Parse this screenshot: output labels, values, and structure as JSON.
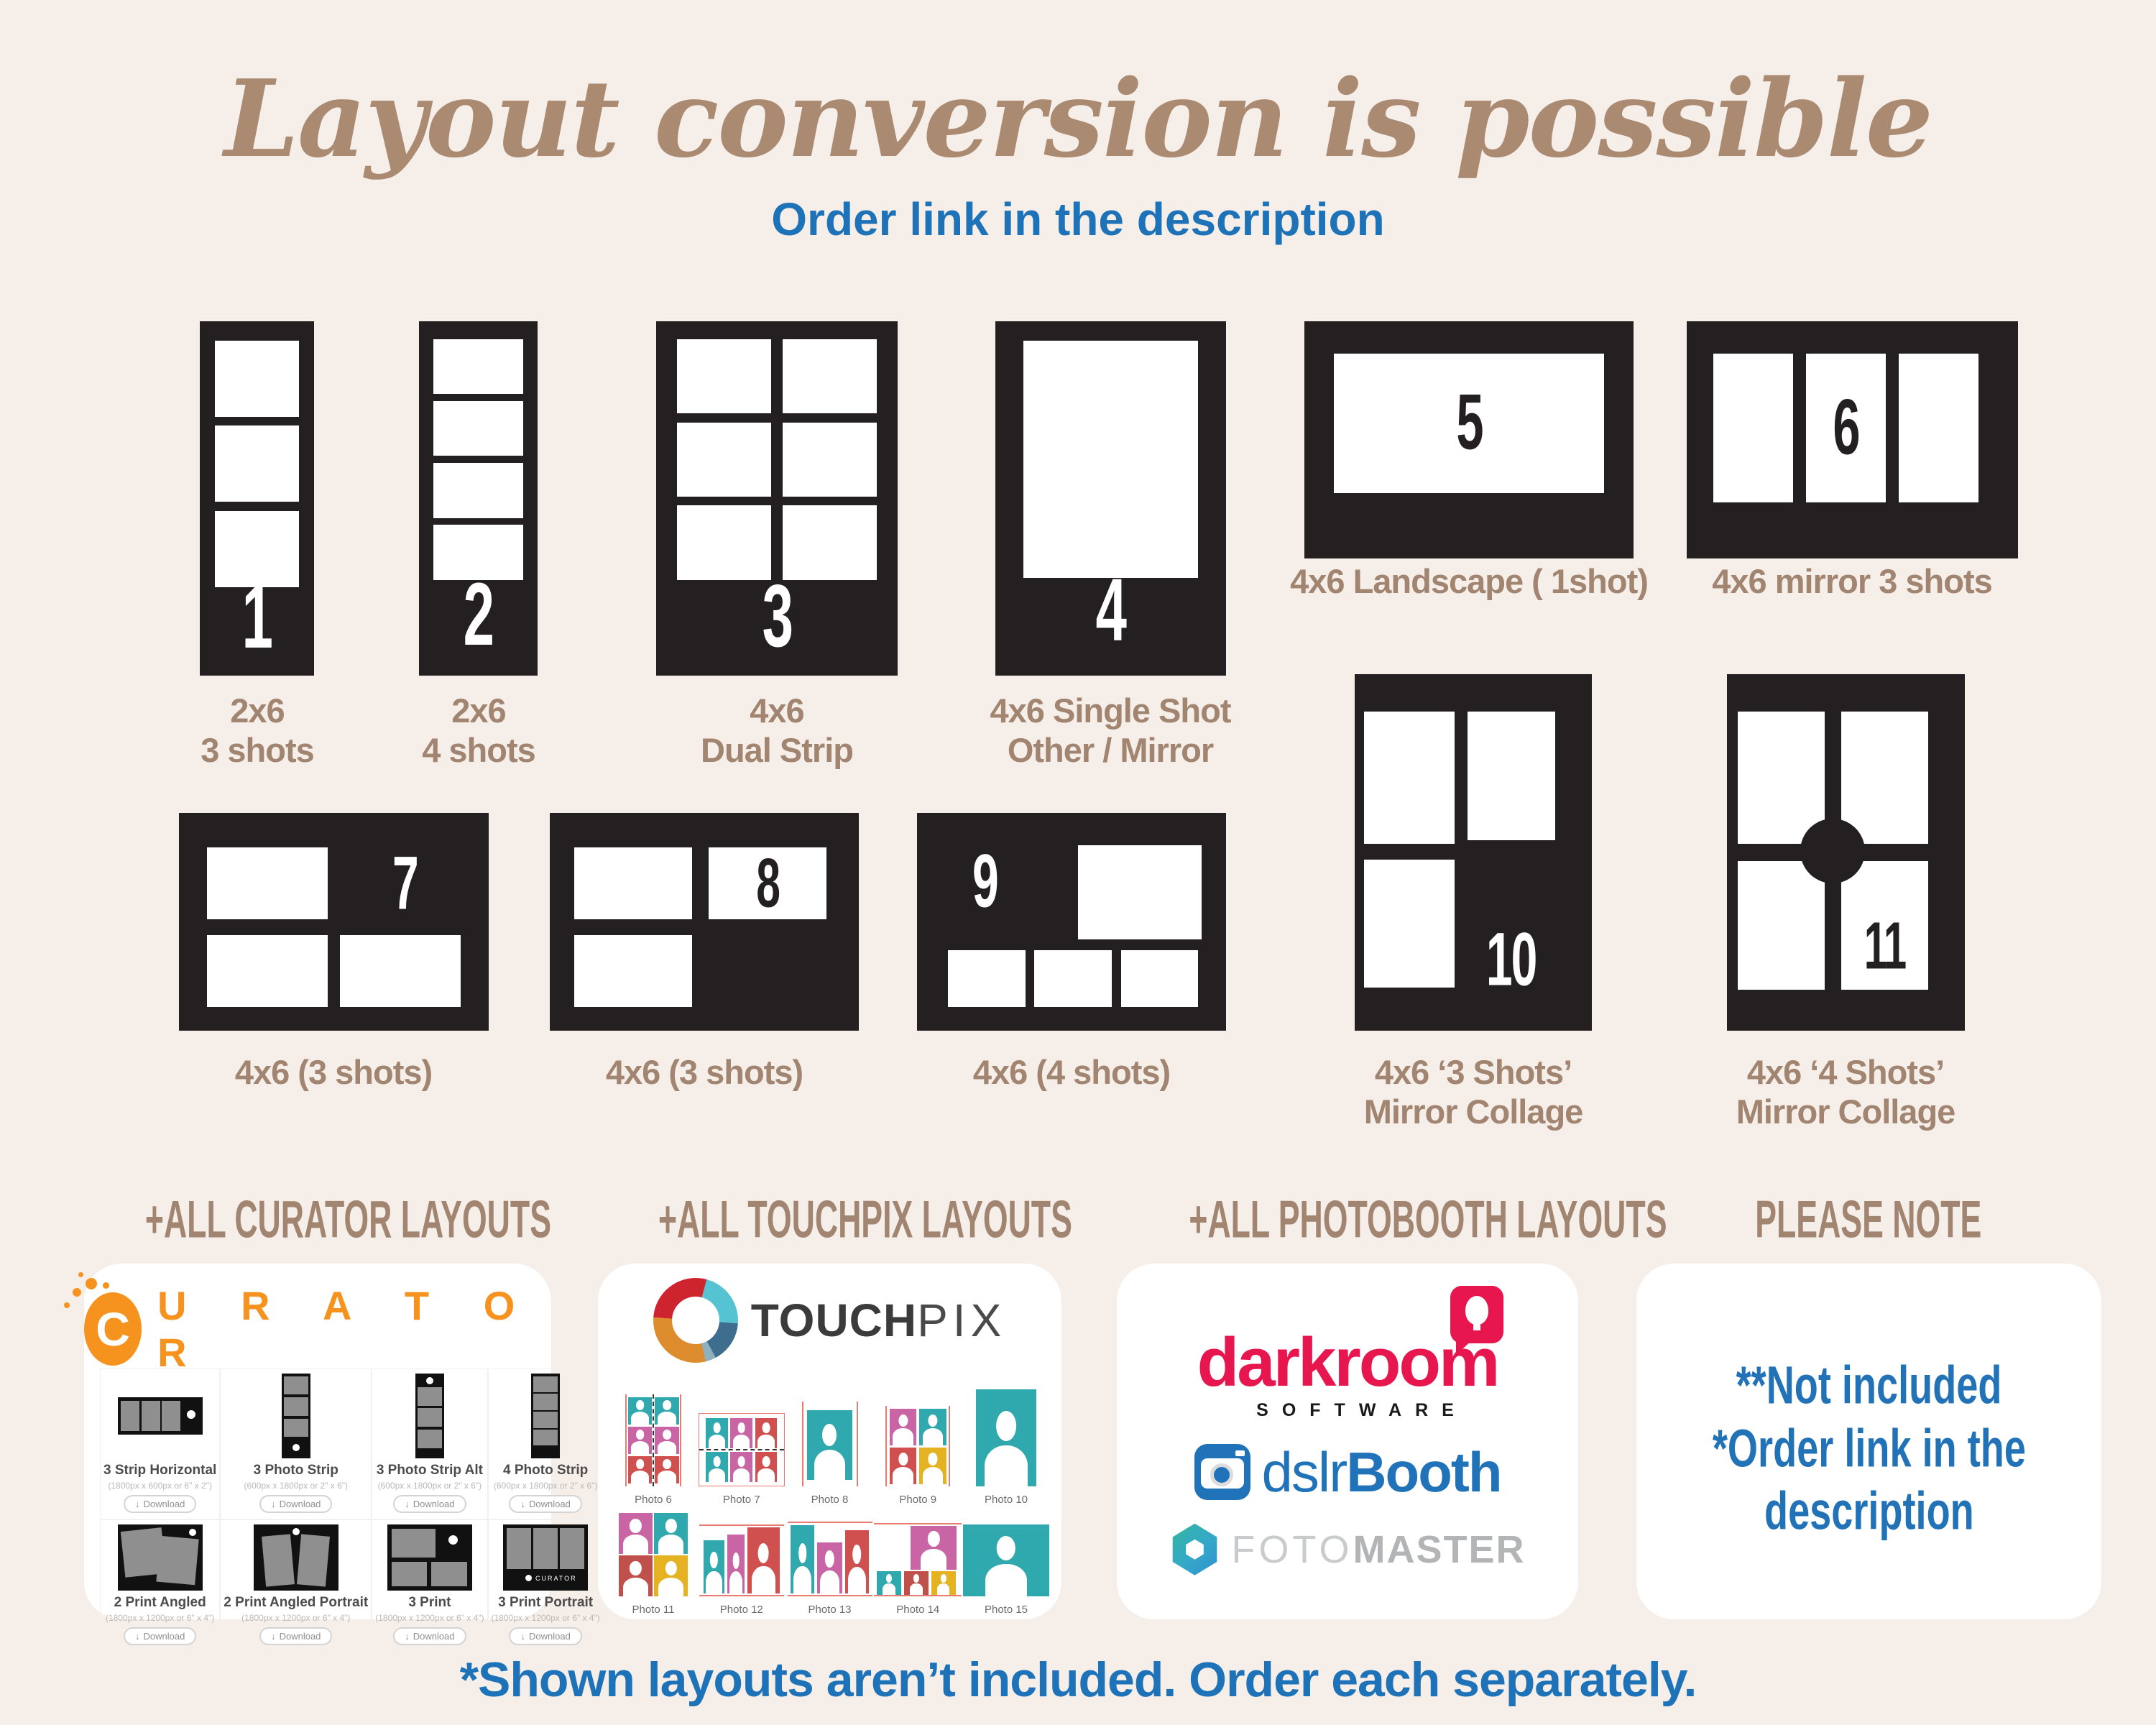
{
  "page": {
    "title": "Layout conversion is possible",
    "subtitle": "Order link in the description",
    "footnote": "*Shown layouts aren’t included. Order each separately."
  },
  "layouts": [
    {
      "number": "1",
      "lines": [
        "2x6",
        "3 shots"
      ]
    },
    {
      "number": "2",
      "lines": [
        "2x6",
        "4 shots"
      ]
    },
    {
      "number": "3",
      "lines": [
        "4x6",
        "Dual Strip"
      ]
    },
    {
      "number": "4",
      "lines": [
        "4x6 Single Shot",
        "Other / Mirror"
      ]
    },
    {
      "number": "5",
      "lines": [
        "4x6 Landscape ( 1shot)"
      ]
    },
    {
      "number": "6",
      "lines": [
        "4x6 mirror 3 shots"
      ]
    },
    {
      "number": "7",
      "lines": [
        "4x6 (3 shots)"
      ]
    },
    {
      "number": "8",
      "lines": [
        "4x6 (3 shots)"
      ]
    },
    {
      "number": "9",
      "lines": [
        "4x6 (4 shots)"
      ]
    },
    {
      "number": "10",
      "lines": [
        "4x6 ‘3 Shots’",
        "Mirror Collage"
      ]
    },
    {
      "number": "11",
      "lines": [
        "4x6 ‘4 Shots’",
        "Mirror Collage"
      ]
    }
  ],
  "curator": {
    "heading": "+ALL CURATOR LAYOUTS",
    "logo_c": "C",
    "logo_rest": "U R A T O R",
    "items": [
      {
        "name": "3 Strip Horizontal",
        "size": "(1800px x 600px or 6\" x 2\")",
        "button": "Download"
      },
      {
        "name": "3 Photo Strip",
        "size": "(600px x 1800px or 2\" x 6\")",
        "button": "Download"
      },
      {
        "name": "3 Photo Strip Alt",
        "size": "(600px x 1800px or 2\" x 6\")",
        "button": "Download"
      },
      {
        "name": "4 Photo Strip",
        "size": "(600px x 1800px or 2\" x 6\")",
        "button": "Download"
      },
      {
        "name": "2 Print Angled",
        "size": "(1800px x 1200px or 6\" x 4\")",
        "button": "Download"
      },
      {
        "name": "2 Print Angled Portrait",
        "size": "(1800px x 1200px or 6\" x 4\")",
        "button": "Download"
      },
      {
        "name": "3 Print",
        "size": "(1800px x 1200px or 6\" x 4\")",
        "button": "Download"
      },
      {
        "name": "3 Print Portrait",
        "size": "(1800px x 1200px or 6\" x 4\")",
        "button": "Download"
      }
    ]
  },
  "touchpix": {
    "heading": "+ALL TOUCHPIX LAYOUTS",
    "logo_bold": "TOUCH",
    "logo_light": "PIX",
    "photos": [
      "Photo 6",
      "Photo 7",
      "Photo 8",
      "Photo 9",
      "Photo 10",
      "Photo 11",
      "Photo 12",
      "Photo 13",
      "Photo 14",
      "Photo 15"
    ]
  },
  "photobooth": {
    "heading": "+ALL PHOTOBOOTH LAYOUTS",
    "darkroom_word": "darkroom",
    "software_word": "SOFTWARE",
    "dslr_word": "dslr",
    "booth_word": "Booth",
    "foto_word": "FOTO",
    "master_word": "MASTER"
  },
  "note": {
    "heading": "PLEASE NOTE",
    "lines": [
      "**Not included",
      "*Order link in the",
      "description"
    ]
  },
  "colors": {
    "background": "#f6eee9",
    "card_black": "#241f20",
    "title_brown": "#ab8a72",
    "label_brown": "#a18571",
    "accent_blue": "#1e73b8",
    "curator_orange": "#f6921e",
    "darkroom_red": "#e8164f",
    "dslrbooth_blue": "#2173b9",
    "touchpix_teal": "#2fa9ad",
    "touchpix_pink": "#c964a5",
    "touchpix_red": "#d0504f",
    "touchpix_yellow": "#e5b322"
  }
}
